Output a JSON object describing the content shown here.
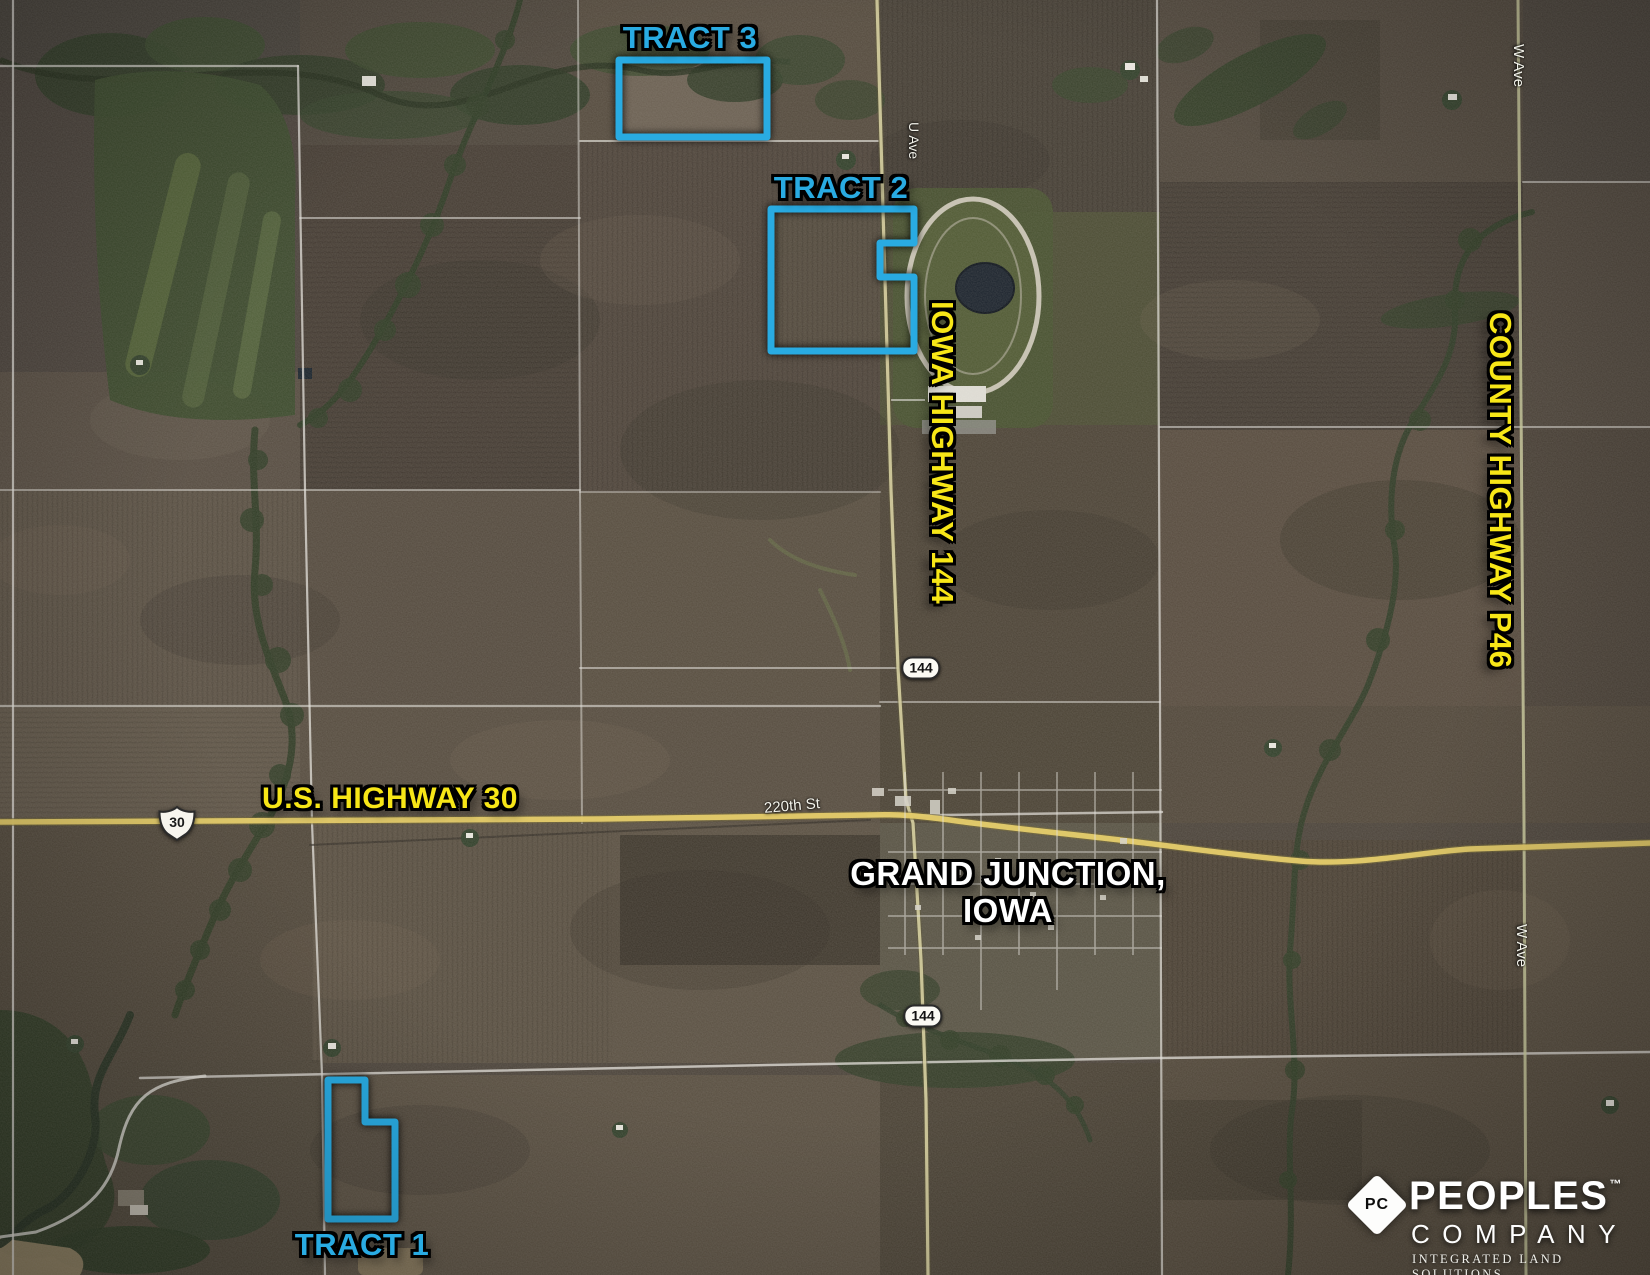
{
  "map": {
    "tracts": {
      "t1": {
        "label": "TRACT 1"
      },
      "t2": {
        "label": "TRACT 2"
      },
      "t3": {
        "label": "TRACT 3"
      }
    },
    "highways": {
      "us30": {
        "label": "U.S. HIGHWAY 30",
        "shield": "30"
      },
      "ia144": {
        "label": "IOWA HIGHWAY 144",
        "shield": "144"
      },
      "p46": {
        "label": "COUNTY HIGHWAY P46"
      }
    },
    "city": {
      "line1": "GRAND JUNCTION,",
      "line2": "IOWA"
    },
    "streets": {
      "u_ave": "U Ave",
      "w_ave_north": "W Ave",
      "w_ave_south": "W Ave",
      "street_220th": "220th St"
    }
  },
  "logo": {
    "monogram": "PC",
    "name": "PEOPLES",
    "trademark": "™",
    "word2": "COMPANY",
    "tagline": "INTEGRATED LAND SOLUTIONS"
  },
  "colors": {
    "tract_outline": "#29abe2",
    "highway_text": "#f7e617",
    "city_text": "#ffffff"
  }
}
